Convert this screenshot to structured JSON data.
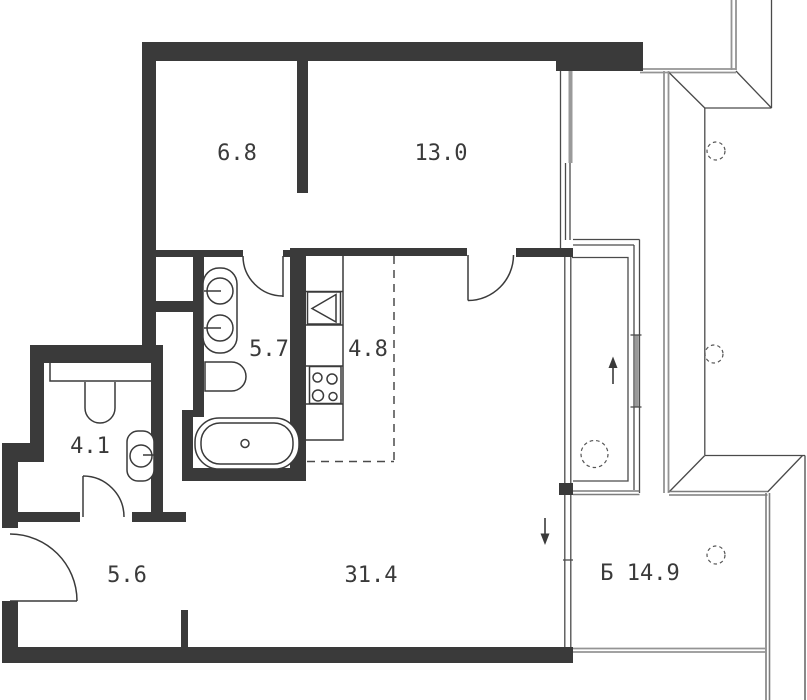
{
  "plan": {
    "title": "apartment-floor-plan",
    "area_units": "m2",
    "rooms": [
      {
        "id": "bedroom-top-left",
        "area_label": "6.8"
      },
      {
        "id": "bedroom-top-right",
        "area_label": "13.0"
      },
      {
        "id": "bathroom",
        "area_label": "5.7"
      },
      {
        "id": "kitchen",
        "area_label": "4.8"
      },
      {
        "id": "wc",
        "area_label": "4.1"
      },
      {
        "id": "hallway",
        "area_label": "5.6"
      },
      {
        "id": "living-room",
        "area_label": "31.4"
      },
      {
        "id": "balcony",
        "area_label": "Б 14.9"
      }
    ],
    "fixtures": [
      "double-washbasin",
      "wall-hung-toilet",
      "bathtub",
      "wc-sink",
      "wc-toilet",
      "kitchen-sink",
      "kitchen-stove",
      "entry-door",
      "wc-door",
      "bathroom-door",
      "living-room-door"
    ],
    "markers": [
      "up-arrow",
      "down-arrow",
      "column-dashed-circles"
    ],
    "colors": {
      "wall": "#3a3a3a",
      "fixture_line": "#3a3a3a",
      "exterior_line": "#949494",
      "thin_line": "#4a4a4a",
      "background": "#ffffff"
    }
  }
}
